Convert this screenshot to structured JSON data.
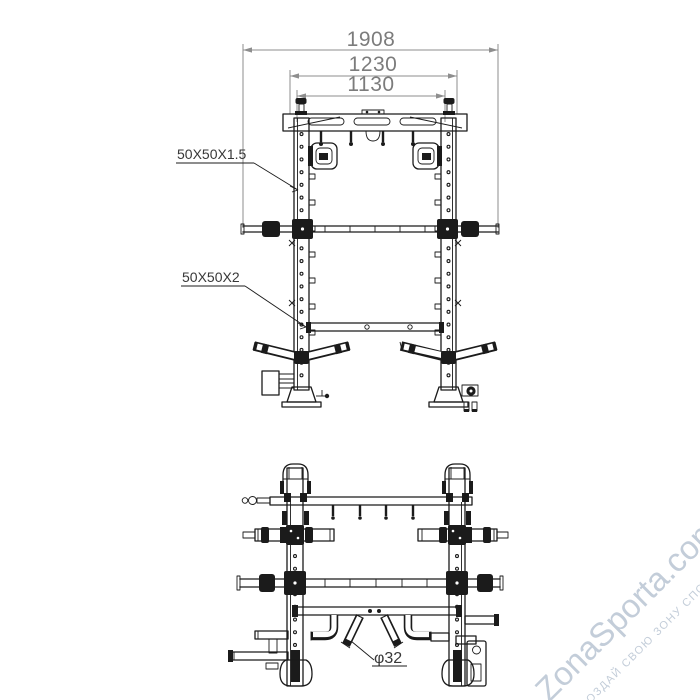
{
  "page": {
    "background": "#ffffff",
    "description": "Technical dimension drawing of a power rack / smith machine, front and rear views"
  },
  "colors": {
    "line": "#1b1b1b",
    "dimension_line": "#8e8e8e",
    "dimension_text": "#7c7c7c",
    "callout_text": "#383838",
    "watermark": "#c3cdd9"
  },
  "front_view": {
    "dimensions": [
      {
        "id": "overall-width",
        "value": "1908"
      },
      {
        "id": "frame-outer-width",
        "value": "1230"
      },
      {
        "id": "frame-inner-width",
        "value": "1130"
      }
    ],
    "callouts": [
      {
        "id": "upright-tube-spec",
        "text": "50X50X1.5"
      },
      {
        "id": "base-tube-spec",
        "text": "50X50X2"
      }
    ]
  },
  "rear_view": {
    "callouts": [
      {
        "id": "bar-diameter",
        "text": "φ32"
      }
    ]
  },
  "watermark": {
    "brand": "ZonaSporta.com",
    "slogan": "СОЗДАЙ СВОЮ ЗОНУ СПОРТА"
  }
}
